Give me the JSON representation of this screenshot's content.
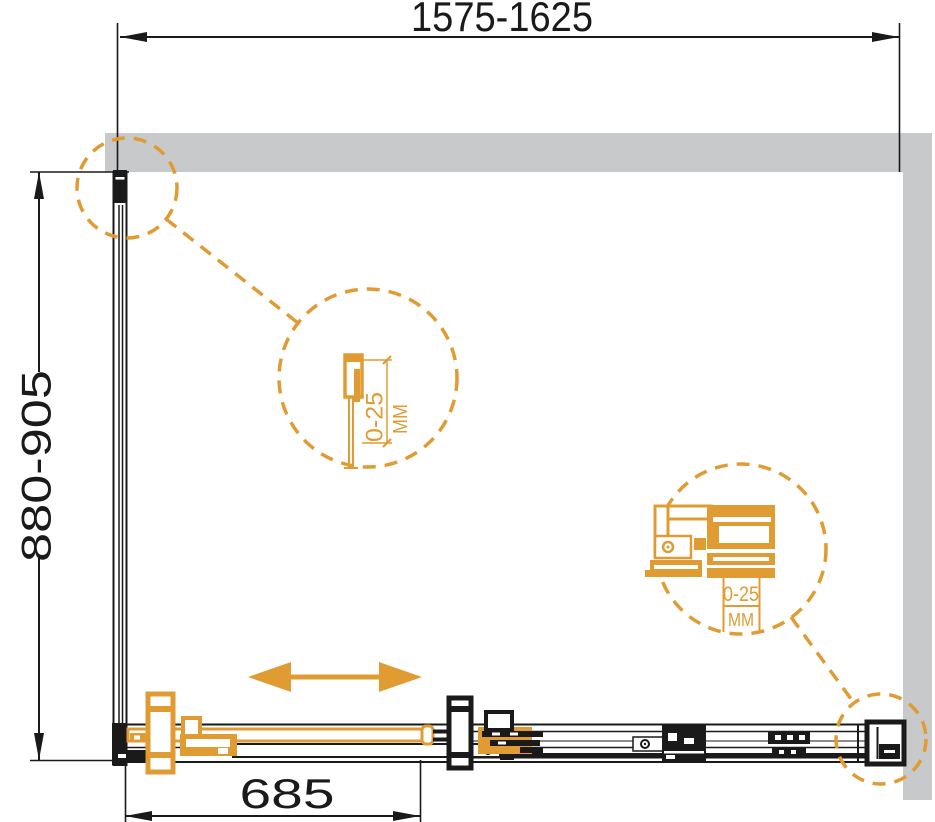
{
  "diagram": {
    "top_dimension": "1575-1625",
    "left_dimension": "880-905",
    "bottom_dimension": "685",
    "middle_callout": {
      "range": "0-25",
      "unit": "MM"
    },
    "right_callout": {
      "range": "0-25",
      "unit": "MM"
    },
    "colors": {
      "accent": "#E09B33",
      "wall": "#C8C9CA",
      "line": "#1A1A1A"
    }
  }
}
